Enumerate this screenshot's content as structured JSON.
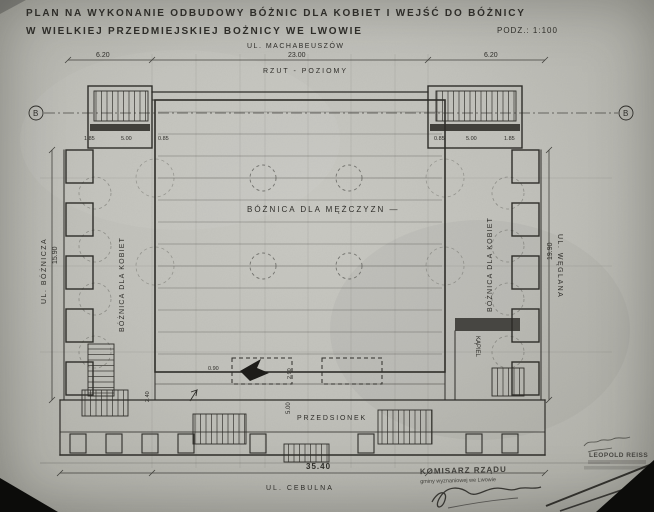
{
  "document": {
    "title_line1": "PLAN NA WYKONANIE ODBUDOWY BÓŻNIC DLA KOBIET I WEJŚĆ DO BÓŻNICY",
    "title_line2": "W WIELKIEJ PRZEDMIEJSKIEJ BOŻNICY WE LWOWIE",
    "scale_note": "PODZ.: 1:100",
    "drawing_type": "RZUT - POZIOMY"
  },
  "streets": {
    "top": "UL. MACHABEUSZÓW",
    "left": "UL. BÓŻNICZA",
    "right": "UL. WĘGLANA",
    "bottom": "UL. CEBULNA"
  },
  "rooms": {
    "main_hall": "BÓŻNICA DLA MĘŻCZYZN —",
    "left_gallery": "BÓŻNICA DLA KOBIET",
    "right_gallery": "BÓŻNICA DLA KOBIET",
    "vestibule": "PRZEDSIONEK",
    "bath": "KĄPIEL"
  },
  "dimensions": {
    "top_left": "6.20",
    "top_center": "23.00",
    "top_right": "6.20",
    "left_height": "15.90",
    "right_height": "19.90",
    "bottom_width": "35.40",
    "stair_left_a": "1.85",
    "stair_left_b": "5.00",
    "stair_left_c": "0.85",
    "stair_right_a": "0.85",
    "stair_right_b": "5.00",
    "stair_right_c": "1.85",
    "entry_offset": "0.90",
    "entry_depth": "2.90",
    "stair_small": "2.40",
    "vestibule_depth": "5.00"
  },
  "markers": {
    "section_left": "B",
    "section_right": "B"
  },
  "stamps": {
    "commissioner_line1": "KOMISARZ RZĄDU",
    "commissioner_line2": "gminy wyznaniowej we Lwowie",
    "architect_name": "LEOPOLD REISS"
  }
}
